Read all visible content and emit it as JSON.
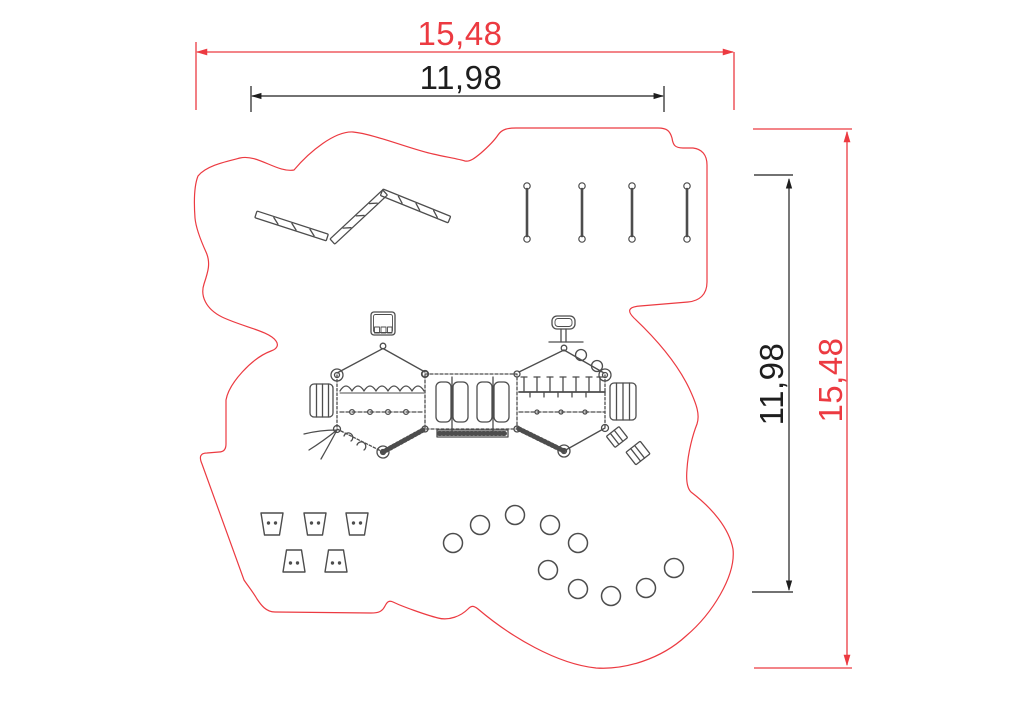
{
  "drawing": {
    "kind": "playground installation plan, top view",
    "units_implied": "m"
  },
  "colors": {
    "safety_zone_red": "#ec3a41",
    "dimension_black": "#1e1e1e",
    "equipment_gray": "#4d4d4d",
    "background": "#ffffff"
  },
  "dimensions": {
    "top_outer": {
      "value": "15,48",
      "orientation": "horizontal",
      "color": "#ec3a41"
    },
    "top_inner": {
      "value": "11,98",
      "orientation": "horizontal",
      "color": "#1e1e1e"
    },
    "right_inner": {
      "value": "11,98",
      "orientation": "vertical",
      "color": "#1e1e1e"
    },
    "right_outer": {
      "value": "15,48",
      "orientation": "vertical",
      "color": "#ec3a41"
    }
  },
  "equipment": {
    "zigzag_balance_beam_segments": 3,
    "stepping_posts": 4,
    "trapezoid_stepping_stones": 5,
    "round_stepping_pods": 10,
    "climbing_structure_bays": 3
  }
}
